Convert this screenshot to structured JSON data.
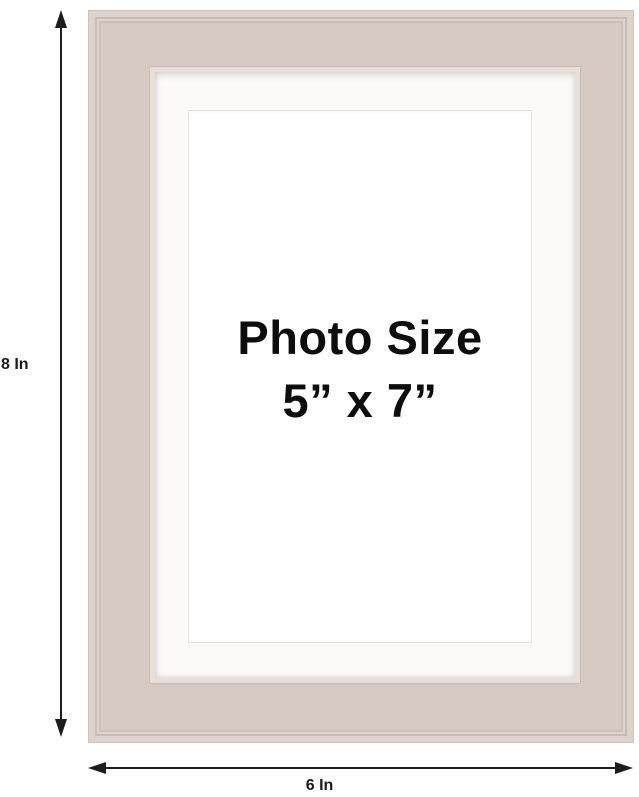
{
  "diagram": {
    "frame_text": {
      "line1": "Photo Size",
      "line2": "5” x 7”"
    },
    "dimensions": {
      "height_label": "8 In",
      "width_label": "6 In"
    },
    "icons": {
      "vertical_arrow": "double-headed-vertical-arrow-icon",
      "horizontal_arrow": "double-headed-horizontal-arrow-icon"
    },
    "colors": {
      "frame": "#d7cac2",
      "frame_groove": "#c8bbb3",
      "frame_highlight": "#ddd3cc",
      "mat": "#fbfaf9",
      "photo_area": "#ffffff",
      "background": "#ffffff",
      "text": "#0d0d0d",
      "dimension_lines": "#1c1c1c"
    }
  }
}
